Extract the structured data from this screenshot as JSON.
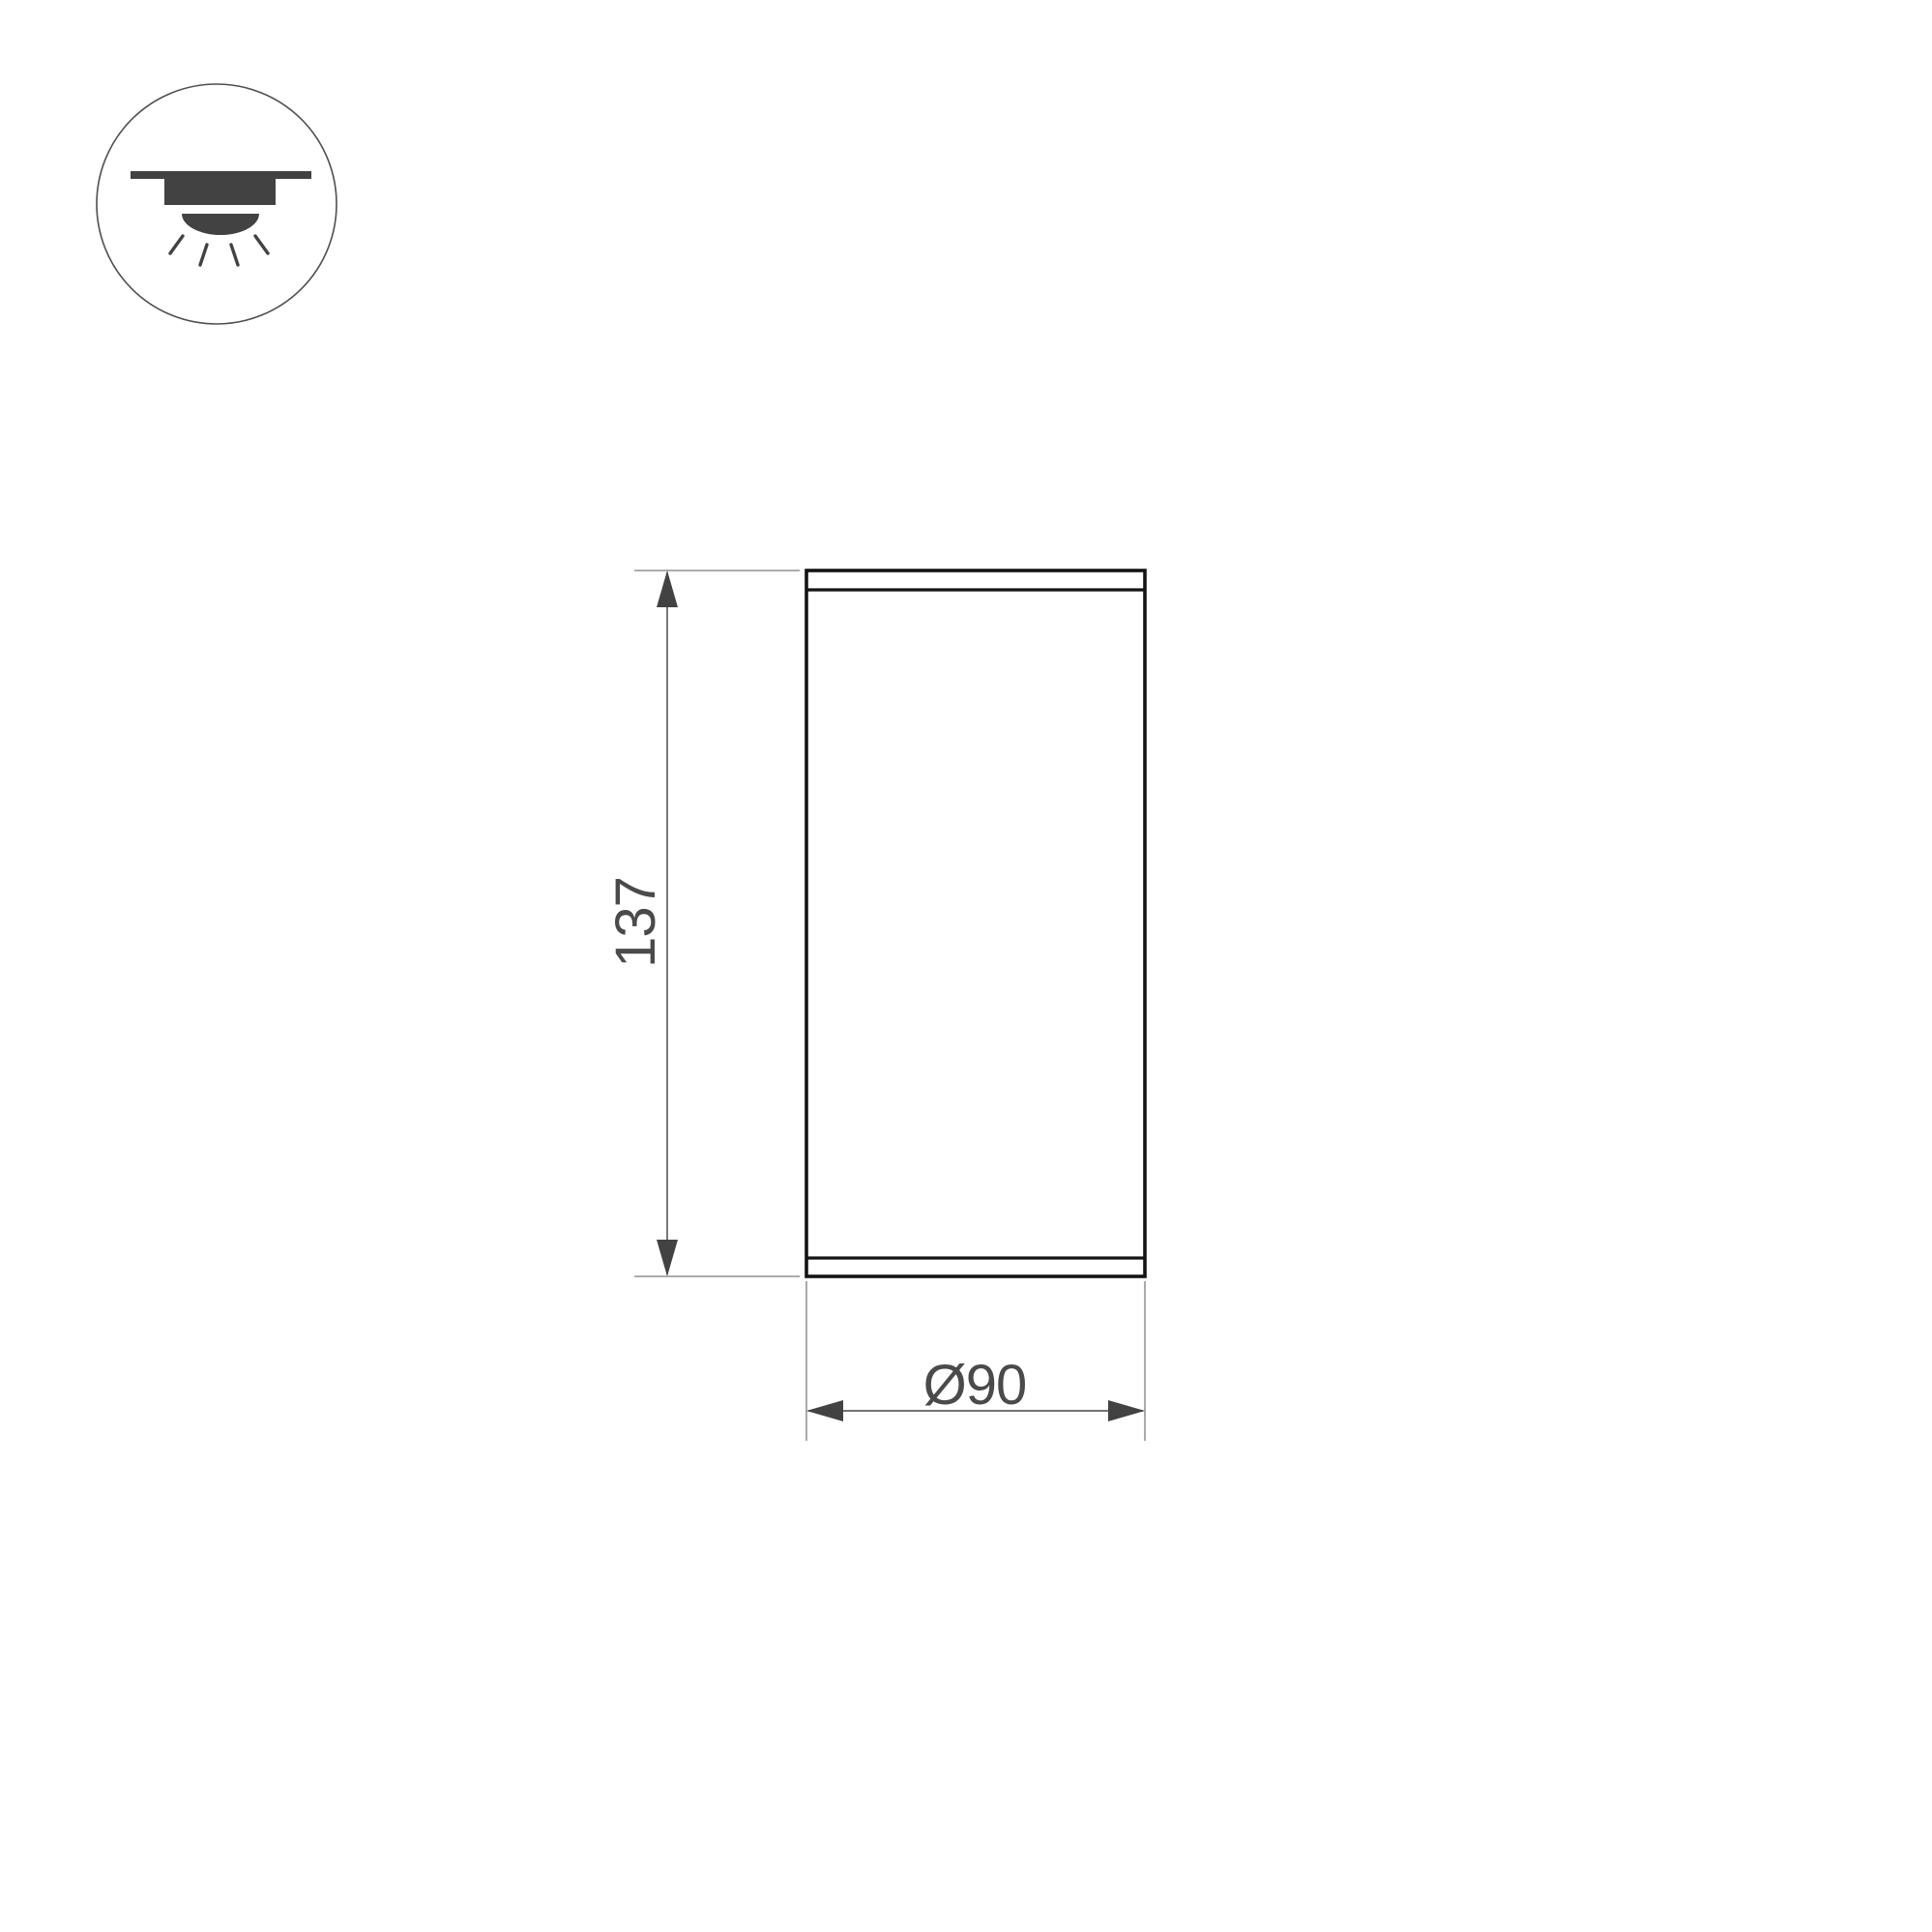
{
  "page": {
    "background_color": "#ffffff"
  },
  "icon_legend": {
    "name": "surface-mounted-downlight-icon",
    "glyph_fill_color": "#424242",
    "circle_outline_color": "#4f4f4f"
  },
  "drawing": {
    "dimensions": {
      "height": {
        "label": "137"
      },
      "diameter": {
        "label": "Ø90"
      }
    },
    "colors": {
      "body_stroke": "#141414",
      "extension_line": "#a0a0a0",
      "dimension_line": "#606060",
      "arrowhead": "#424242",
      "text": "#4a4a4a"
    }
  }
}
